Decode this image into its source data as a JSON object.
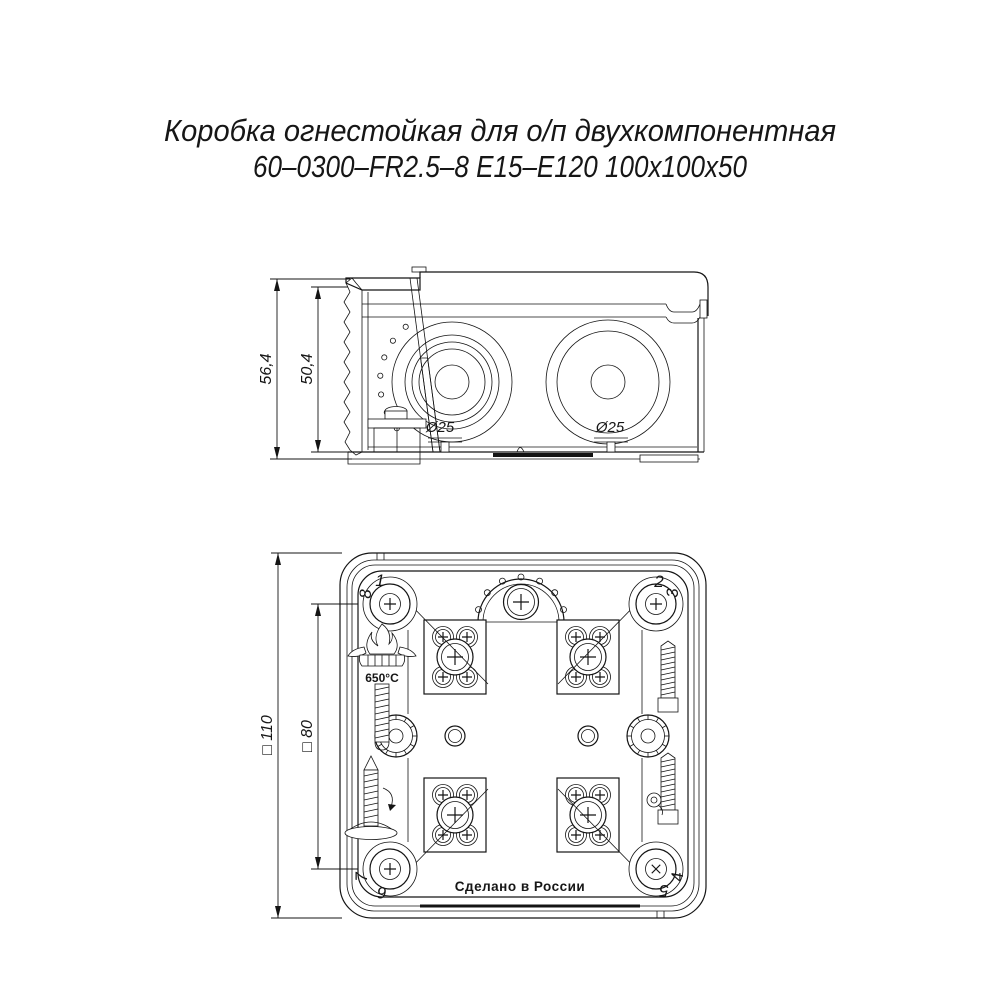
{
  "title": {
    "line1": "Коробка огнестойкая для о/п двухкомпонентная",
    "line2": "60–0300–FR2.5–8 Е15–Е120 100x100x50"
  },
  "side_view": {
    "dim_height_outer": "56,4",
    "dim_height_inner": "50,4",
    "knockout_left_label": "Ø25",
    "knockout_right_label": "Ø25"
  },
  "bottom_view": {
    "dim_width_outer": "□ 110",
    "dim_width_inner": "□ 80",
    "corner_numbers": [
      "1",
      "2",
      "3",
      "4",
      "5",
      "6",
      "7",
      "8"
    ],
    "temperature_label": "650°C",
    "made_in_label": "Сделано в России"
  }
}
